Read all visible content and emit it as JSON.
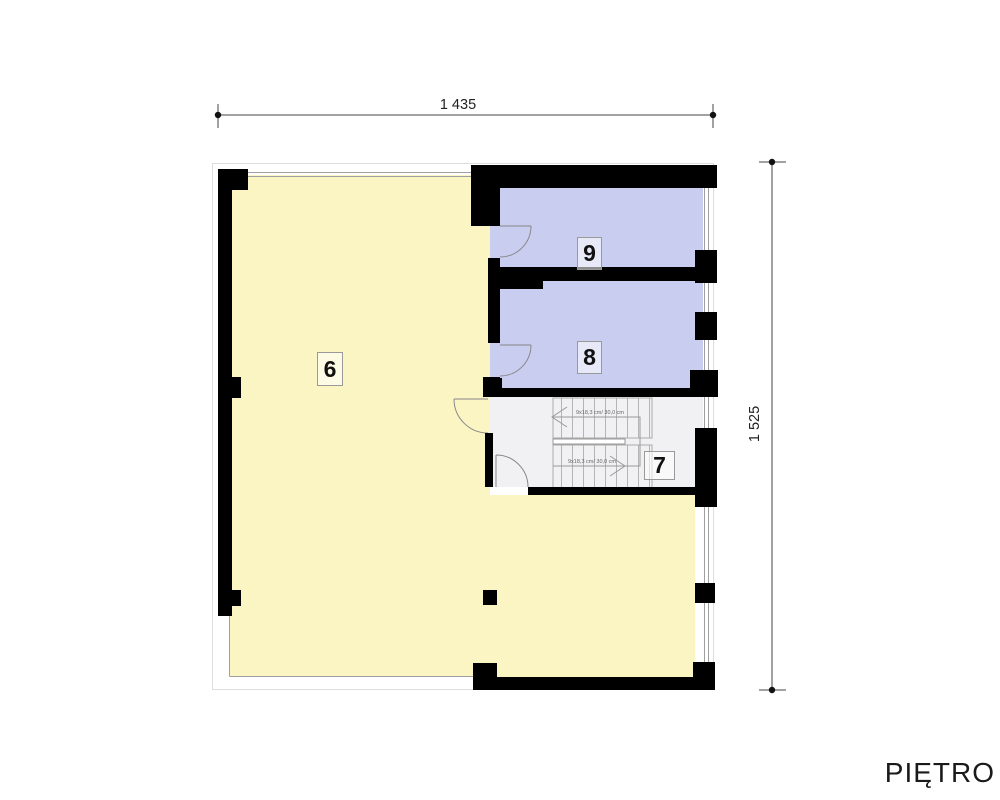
{
  "title": "PIĘTRO",
  "dimensions": {
    "width_label": "1 435",
    "height_label": "1 525"
  },
  "rooms": {
    "r6": "6",
    "r7": "7",
    "r8": "8",
    "r9": "9"
  },
  "stairs": {
    "flight_up_label": "9x18,3 cm/ 30,0 cm",
    "flight_down_label": "9x18,3 cm/ 30,0 cm"
  },
  "colors": {
    "wall": "#000000",
    "room_main": "#fbf5c3",
    "rooms_small": "#c9cdf0",
    "stairwell": "#f1f1f3",
    "dimension": "#333333"
  }
}
